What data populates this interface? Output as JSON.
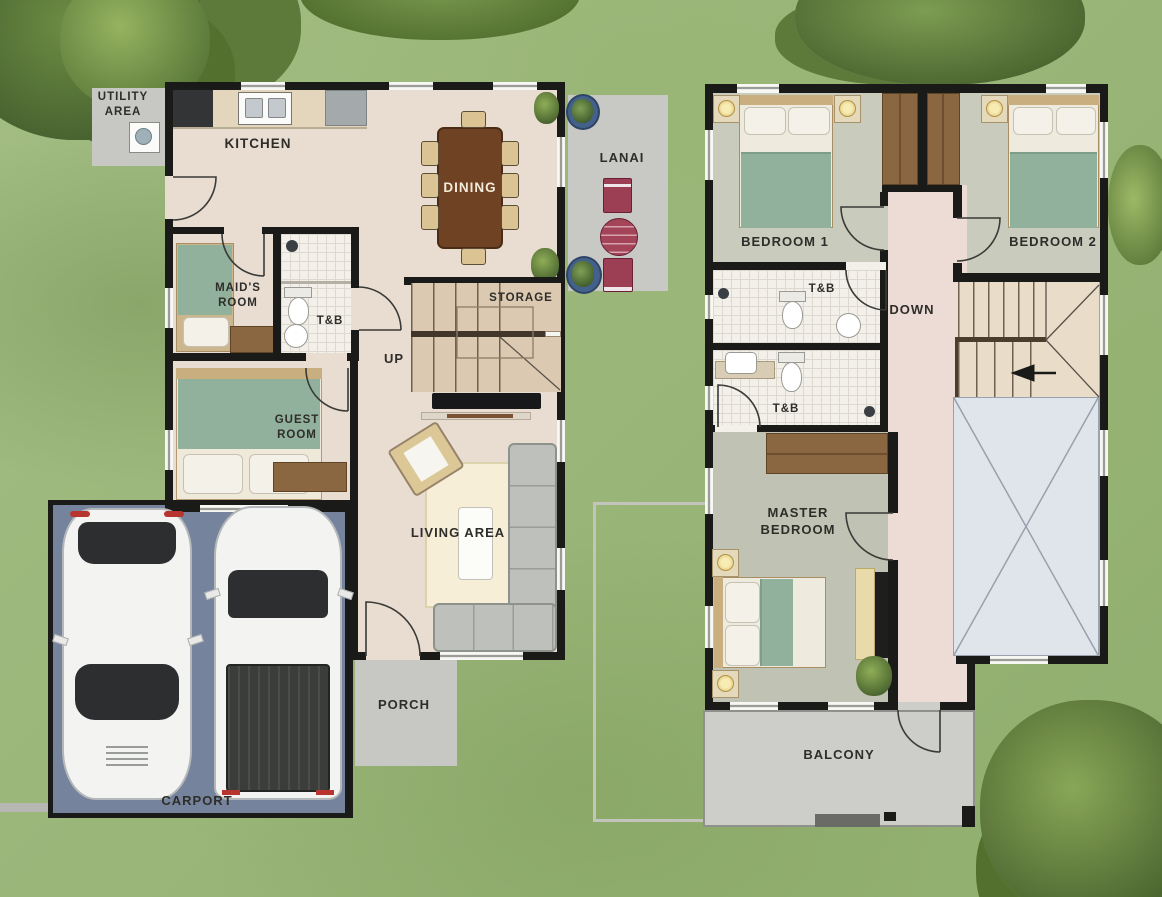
{
  "title": "Two-storey house floor plan",
  "ground_floor": {
    "rooms": {
      "utility_area": "UTILITY AREA",
      "kitchen": "KITCHEN",
      "dining": "DINING",
      "lanai": "LANAI",
      "maids_room": "MAID'S ROOM",
      "toilet_bath": "T&B",
      "storage": "STORAGE",
      "stairs_direction": "UP",
      "guest_room": "GUEST ROOM",
      "living_area": "LIVING AREA",
      "porch": "PORCH",
      "carport": "CARPORT"
    }
  },
  "second_floor": {
    "rooms": {
      "bedroom1": "BEDROOM 1",
      "bedroom2": "BEDROOM 2",
      "toilet_bath_upper": "T&B",
      "stairs_direction": "DOWN",
      "toilet_bath_lower": "T&B",
      "master_bedroom": "MASTER BEDROOM",
      "balcony": "BALCONY"
    }
  },
  "colors": {
    "wall": "#1a1a18",
    "grass": "#9ab677",
    "tree_dark": "#46602f",
    "tree_light": "#86a355",
    "interior_floor": "#e9ddd2",
    "bedroom_floor": "#c9cbbd",
    "master_floor": "#c0c2b3",
    "hall_floor": "#ecdcd5",
    "tile": "#f2f0e9",
    "paved_gray": "#c7c7c4",
    "carport": "#75849c",
    "stair_tread": "#dbc9b2",
    "open_area_blue": "#e0e5ec",
    "dining_table_brown": "#6f4224",
    "closet_brown": "#8a6740",
    "blanket_green": "#92b19c",
    "lanai_furniture_maroon": "#9c3f55",
    "sofa_gray": "#bdc0bb",
    "rug_cream": "#f6eed6",
    "car_white": "#f3f4f2",
    "glass_dark": "#2c2e30"
  },
  "icons": {
    "down-direction-arrow": "left-pointing solid triangle",
    "washing-machine": "white square with drum circle",
    "potted-plant": "green blob in round blue pot",
    "door-swing": "quarter-circle arc",
    "window": "white gap with thin mullion line in wall"
  }
}
